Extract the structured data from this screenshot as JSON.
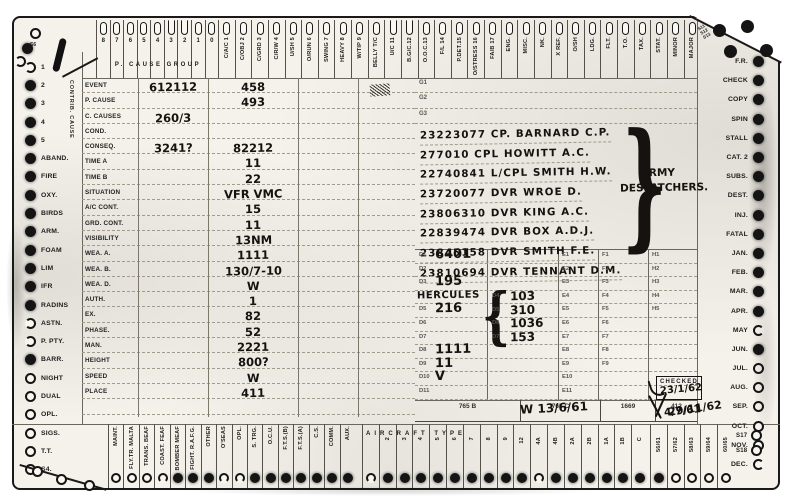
{
  "top": {
    "cause_group_label": "P. CAUSE GROUP",
    "digits": [
      {
        "label": "8",
        "state": "closed"
      },
      {
        "label": "7",
        "state": "closed"
      },
      {
        "label": "6",
        "state": "closed"
      },
      {
        "label": "5",
        "state": "closed"
      },
      {
        "label": "4",
        "state": "closed"
      },
      {
        "label": "3",
        "state": "notch"
      },
      {
        "label": "2",
        "state": "notch"
      },
      {
        "label": "1",
        "state": "closed"
      },
      {
        "label": "0",
        "state": "closed"
      }
    ],
    "slots": [
      {
        "label": "C/A/C 1",
        "state": "closed"
      },
      {
        "label": "C/OBJ 2",
        "state": "closed"
      },
      {
        "label": "C/GRD 3",
        "state": "closed"
      },
      {
        "label": "C/R/W 4",
        "state": "closed"
      },
      {
        "label": "U/SH 5",
        "state": "closed"
      },
      {
        "label": "O/RUN 6",
        "state": "closed"
      },
      {
        "label": "SWING 7",
        "state": "closed"
      },
      {
        "label": "HEAVY 8",
        "state": "closed"
      },
      {
        "label": "W/TIP 9",
        "state": "closed"
      },
      {
        "label": "BELLY T/C",
        "state": "closed"
      },
      {
        "label": "U/C 11",
        "state": "notch"
      },
      {
        "label": "B.G/C.12",
        "state": "notch"
      },
      {
        "label": "O.O.C.13",
        "state": "closed"
      },
      {
        "label": "F/L 14",
        "state": "closed"
      },
      {
        "label": "P.DET.15",
        "state": "closed"
      },
      {
        "label": "O/STRESS 16",
        "state": "closed"
      },
      {
        "label": "FA/B 17",
        "state": "closed"
      },
      {
        "label": "ENG.",
        "state": "closed"
      },
      {
        "label": "MISC.",
        "state": "closed"
      },
      {
        "label": "NK.",
        "state": "closed"
      },
      {
        "label": "X REF.",
        "state": "closed"
      },
      {
        "label": "O/SH",
        "state": "closed"
      },
      {
        "label": "LDG.",
        "state": "closed"
      },
      {
        "label": "FLT.",
        "state": "closed"
      },
      {
        "label": "T.O.",
        "state": "closed"
      },
      {
        "label": "TAX.",
        "state": "closed"
      },
      {
        "label": "STAT.",
        "state": "closed"
      },
      {
        "label": "MINOR",
        "state": "closed"
      },
      {
        "label": "MAJOR",
        "state": "closed"
      }
    ],
    "corner_labels": [
      "S11",
      "S12",
      "S13"
    ]
  },
  "left": {
    "contrib_label": "CONTRIB. CAUSE",
    "corner_label": "S6",
    "rows": [
      {
        "label": "1",
        "state": "n-left"
      },
      {
        "label": "2",
        "state": "f"
      },
      {
        "label": "3",
        "state": "f"
      },
      {
        "label": "4",
        "state": "f"
      },
      {
        "label": "5",
        "state": "f"
      },
      {
        "label": "ABAND.",
        "state": "f"
      },
      {
        "label": "FIRE",
        "state": "f"
      },
      {
        "label": "OXY.",
        "state": "f"
      },
      {
        "label": "BIRDS",
        "state": "f"
      },
      {
        "label": "ARM.",
        "state": "f"
      },
      {
        "label": "FOAM",
        "state": "f"
      },
      {
        "label": "LIM",
        "state": "f"
      },
      {
        "label": "IFR",
        "state": "f"
      },
      {
        "label": "RADINS",
        "state": "f"
      },
      {
        "label": "ASTN.",
        "state": "n-left"
      },
      {
        "label": "P. PTY.",
        "state": "n-left"
      },
      {
        "label": "BARR.",
        "state": "f"
      },
      {
        "label": "NIGHT",
        "state": "o"
      },
      {
        "label": "DUAL",
        "state": "o"
      },
      {
        "label": "OPL.",
        "state": "o"
      },
      {
        "label": "SIGS.",
        "state": "o"
      },
      {
        "label": "T.T.",
        "state": "o"
      },
      {
        "label": "S4.",
        "state": "o"
      }
    ]
  },
  "right": {
    "rows": [
      {
        "label": "F.R.",
        "state": "f"
      },
      {
        "label": "CHECK",
        "state": "f"
      },
      {
        "label": "COPY",
        "state": "f"
      },
      {
        "label": "SPIN",
        "state": "f"
      },
      {
        "label": "STALL",
        "state": "f"
      },
      {
        "label": "CAT. 2",
        "state": "f"
      },
      {
        "label": "SUBS.",
        "state": "f"
      },
      {
        "label": "DEST.",
        "state": "f"
      },
      {
        "label": "INJ.",
        "state": "f"
      },
      {
        "label": "FATAL",
        "state": "f"
      },
      {
        "label": "JAN.",
        "state": "f"
      },
      {
        "label": "FEB.",
        "state": "f"
      },
      {
        "label": "MAR.",
        "state": "f"
      },
      {
        "label": "APR.",
        "state": "f"
      },
      {
        "label": "MAY",
        "state": "n-right"
      },
      {
        "label": "JUN.",
        "state": "f"
      },
      {
        "label": "JUL.",
        "state": "o"
      },
      {
        "label": "AUG.",
        "state": "o"
      },
      {
        "label": "SEP.",
        "state": "o"
      },
      {
        "label": "OCT.",
        "state": "o"
      },
      {
        "label": "NOV.",
        "state": "o"
      },
      {
        "label": "DEC.",
        "state": "n-right"
      }
    ],
    "corner_labels": [
      "S17",
      "S18"
    ]
  },
  "bottom": {
    "group1": [
      {
        "label": "MAINT.",
        "state": "o"
      },
      {
        "label": "FLY.TR. MALTA",
        "state": "o"
      },
      {
        "label": "TRANS. BEAF",
        "state": "o"
      },
      {
        "label": "COAST. FEAF",
        "state": "n-down"
      },
      {
        "label": "BOMBER MEAF",
        "state": "f"
      },
      {
        "label": "FIGHT. R.A.F.G.",
        "state": "f"
      },
      {
        "label": "OTHER",
        "state": "f"
      },
      {
        "label": "O'SEAS",
        "state": "n-down"
      },
      {
        "label": "OPL.",
        "state": "n-down"
      },
      {
        "label": "S. TRG.",
        "state": "f"
      },
      {
        "label": "O.C.U.",
        "state": "f"
      },
      {
        "label": "F.T.S.(B)",
        "state": "f"
      },
      {
        "label": "F.T.S.(A)",
        "state": "f"
      },
      {
        "label": "C.S.",
        "state": "f"
      },
      {
        "label": "COMM.",
        "state": "f"
      },
      {
        "label": "AUX.",
        "state": "f"
      }
    ],
    "type_header": "AIRCRAFT TYPE",
    "type_slots": [
      {
        "label": "",
        "state": "n-down"
      },
      {
        "label": "2",
        "state": "f"
      },
      {
        "label": "3",
        "state": "f"
      },
      {
        "label": "4",
        "state": "f"
      },
      {
        "label": "5",
        "state": "f"
      },
      {
        "label": "6",
        "state": "f"
      },
      {
        "label": "7",
        "state": "f"
      },
      {
        "label": "8",
        "state": "f"
      },
      {
        "label": "9",
        "state": "f"
      },
      {
        "label": "12",
        "state": "f"
      },
      {
        "label": "4A",
        "state": "n-down"
      },
      {
        "label": "4B",
        "state": "f"
      },
      {
        "label": "2A",
        "state": "f"
      },
      {
        "label": "2B",
        "state": "f"
      },
      {
        "label": "1A",
        "state": "f"
      },
      {
        "label": "1B",
        "state": "f"
      },
      {
        "label": "C",
        "state": "f"
      }
    ],
    "year_slots": [
      {
        "label": "56/61",
        "state": "f"
      },
      {
        "label": "57/62",
        "state": "o"
      },
      {
        "label": "58/63",
        "state": "o"
      },
      {
        "label": "59/64",
        "state": "o"
      },
      {
        "label": "60/65",
        "state": "o"
      }
    ]
  },
  "main": {
    "rows": [
      {
        "label": "EVENT",
        "c1": "612112",
        "c2": "458"
      },
      {
        "label": "P. CAUSE",
        "c1": "",
        "c2": "493"
      },
      {
        "label": "C. CAUSES",
        "c1": "260/3",
        "c2": ""
      },
      {
        "label": "COND.",
        "c1": "",
        "c2": ""
      },
      {
        "label": "CONSEQ.",
        "c1": "3241?",
        "c2": "82212"
      },
      {
        "label": "TIME A",
        "c1": "",
        "c2": "11"
      },
      {
        "label": "TIME B",
        "c1": "",
        "c2": "22"
      },
      {
        "label": "SITUATION",
        "c1": "",
        "c2": "VFR VMC"
      },
      {
        "label": "A/C CONT.",
        "c1": "",
        "c2": "15"
      },
      {
        "label": "GRD. CONT.",
        "c1": "",
        "c2": "11"
      },
      {
        "label": "VISIBILITY",
        "c1": "",
        "c2": "13NM"
      },
      {
        "label": "WEA. A.",
        "c1": "",
        "c2": "1111"
      },
      {
        "label": "WEA. B.",
        "c1": "",
        "c2": "130/7-10"
      },
      {
        "label": "WEA. D.",
        "c1": "",
        "c2": "W"
      },
      {
        "label": "AUTH.",
        "c1": "",
        "c2": "1"
      },
      {
        "label": "EX.",
        "c1": "",
        "c2": "82"
      },
      {
        "label": "PHASE.",
        "c1": "",
        "c2": "52"
      },
      {
        "label": "MAN.",
        "c1": "",
        "c2": "2221"
      },
      {
        "label": "HEIGHT",
        "c1": "",
        "c2": "800?"
      },
      {
        "label": "SPEED",
        "c1": "",
        "c2": "W"
      },
      {
        "label": "PLACE",
        "c1": "",
        "c2": "411"
      },
      {
        "label": "",
        "c1": "",
        "c2": ""
      }
    ]
  },
  "crew": {
    "g_labels": [
      "G1",
      "G2",
      "G3"
    ],
    "names": [
      "23223077 CP. BARNARD C.P.",
      "277010 CPL HOWITT A.C.",
      "22740841 L/CPL SMITH H.W.",
      "23720077 DVR WROE D.",
      "23806310 DVR KING A.C.",
      "22839474 DVR BOX A.D.J.",
      "23845158 DVR SMITH F.E.",
      "23810694 DVR TENNANT D.M."
    ],
    "brace": "}",
    "group_label_line1": "ARMY",
    "group_label_line2": "DESPATCHERS."
  },
  "dblock": {
    "rows": [
      {
        "label": "D1",
        "value": "6401"
      },
      {
        "label": "D2",
        "value": ""
      },
      {
        "label": "D3",
        "value": "195"
      },
      {
        "label": "",
        "value": ""
      },
      {
        "label": "D5",
        "value": "216"
      },
      {
        "label": "D6",
        "value": ""
      },
      {
        "label": "D7",
        "value": ""
      },
      {
        "label": "D8",
        "value": "1111"
      },
      {
        "label": "D9",
        "value": "11"
      },
      {
        "label": "D10",
        "value": "V"
      },
      {
        "label": "D11",
        "value": ""
      }
    ],
    "note": "HERCULES",
    "brace": "{",
    "sub_rows": [
      {
        "label": "D4",
        "value": "103"
      },
      {
        "label": "D5",
        "value": "310"
      },
      {
        "label": "D6",
        "value": "1036"
      },
      {
        "label": "D7",
        "value": "153"
      }
    ],
    "e_labels": [
      "E1",
      "E2",
      "E3",
      "E4",
      "E5",
      "E6",
      "E7",
      "E8",
      "E9",
      "E10",
      "E11"
    ],
    "f_labels": [
      "F1",
      "F2",
      "F3",
      "F4",
      "F5",
      "F6",
      "F7",
      "F8",
      "F9"
    ],
    "h_labels": [
      "H1",
      "H2",
      "H3",
      "H4",
      "H5"
    ]
  },
  "forms": {
    "cells": [
      "765 B",
      "765 C",
      "1669",
      "412"
    ],
    "hw_765c": "W 13/6/61",
    "hw_412": "4/7/61"
  },
  "checked": {
    "label": "CHECKED",
    "dates": [
      "23/1/62",
      "29/11/62"
    ]
  }
}
